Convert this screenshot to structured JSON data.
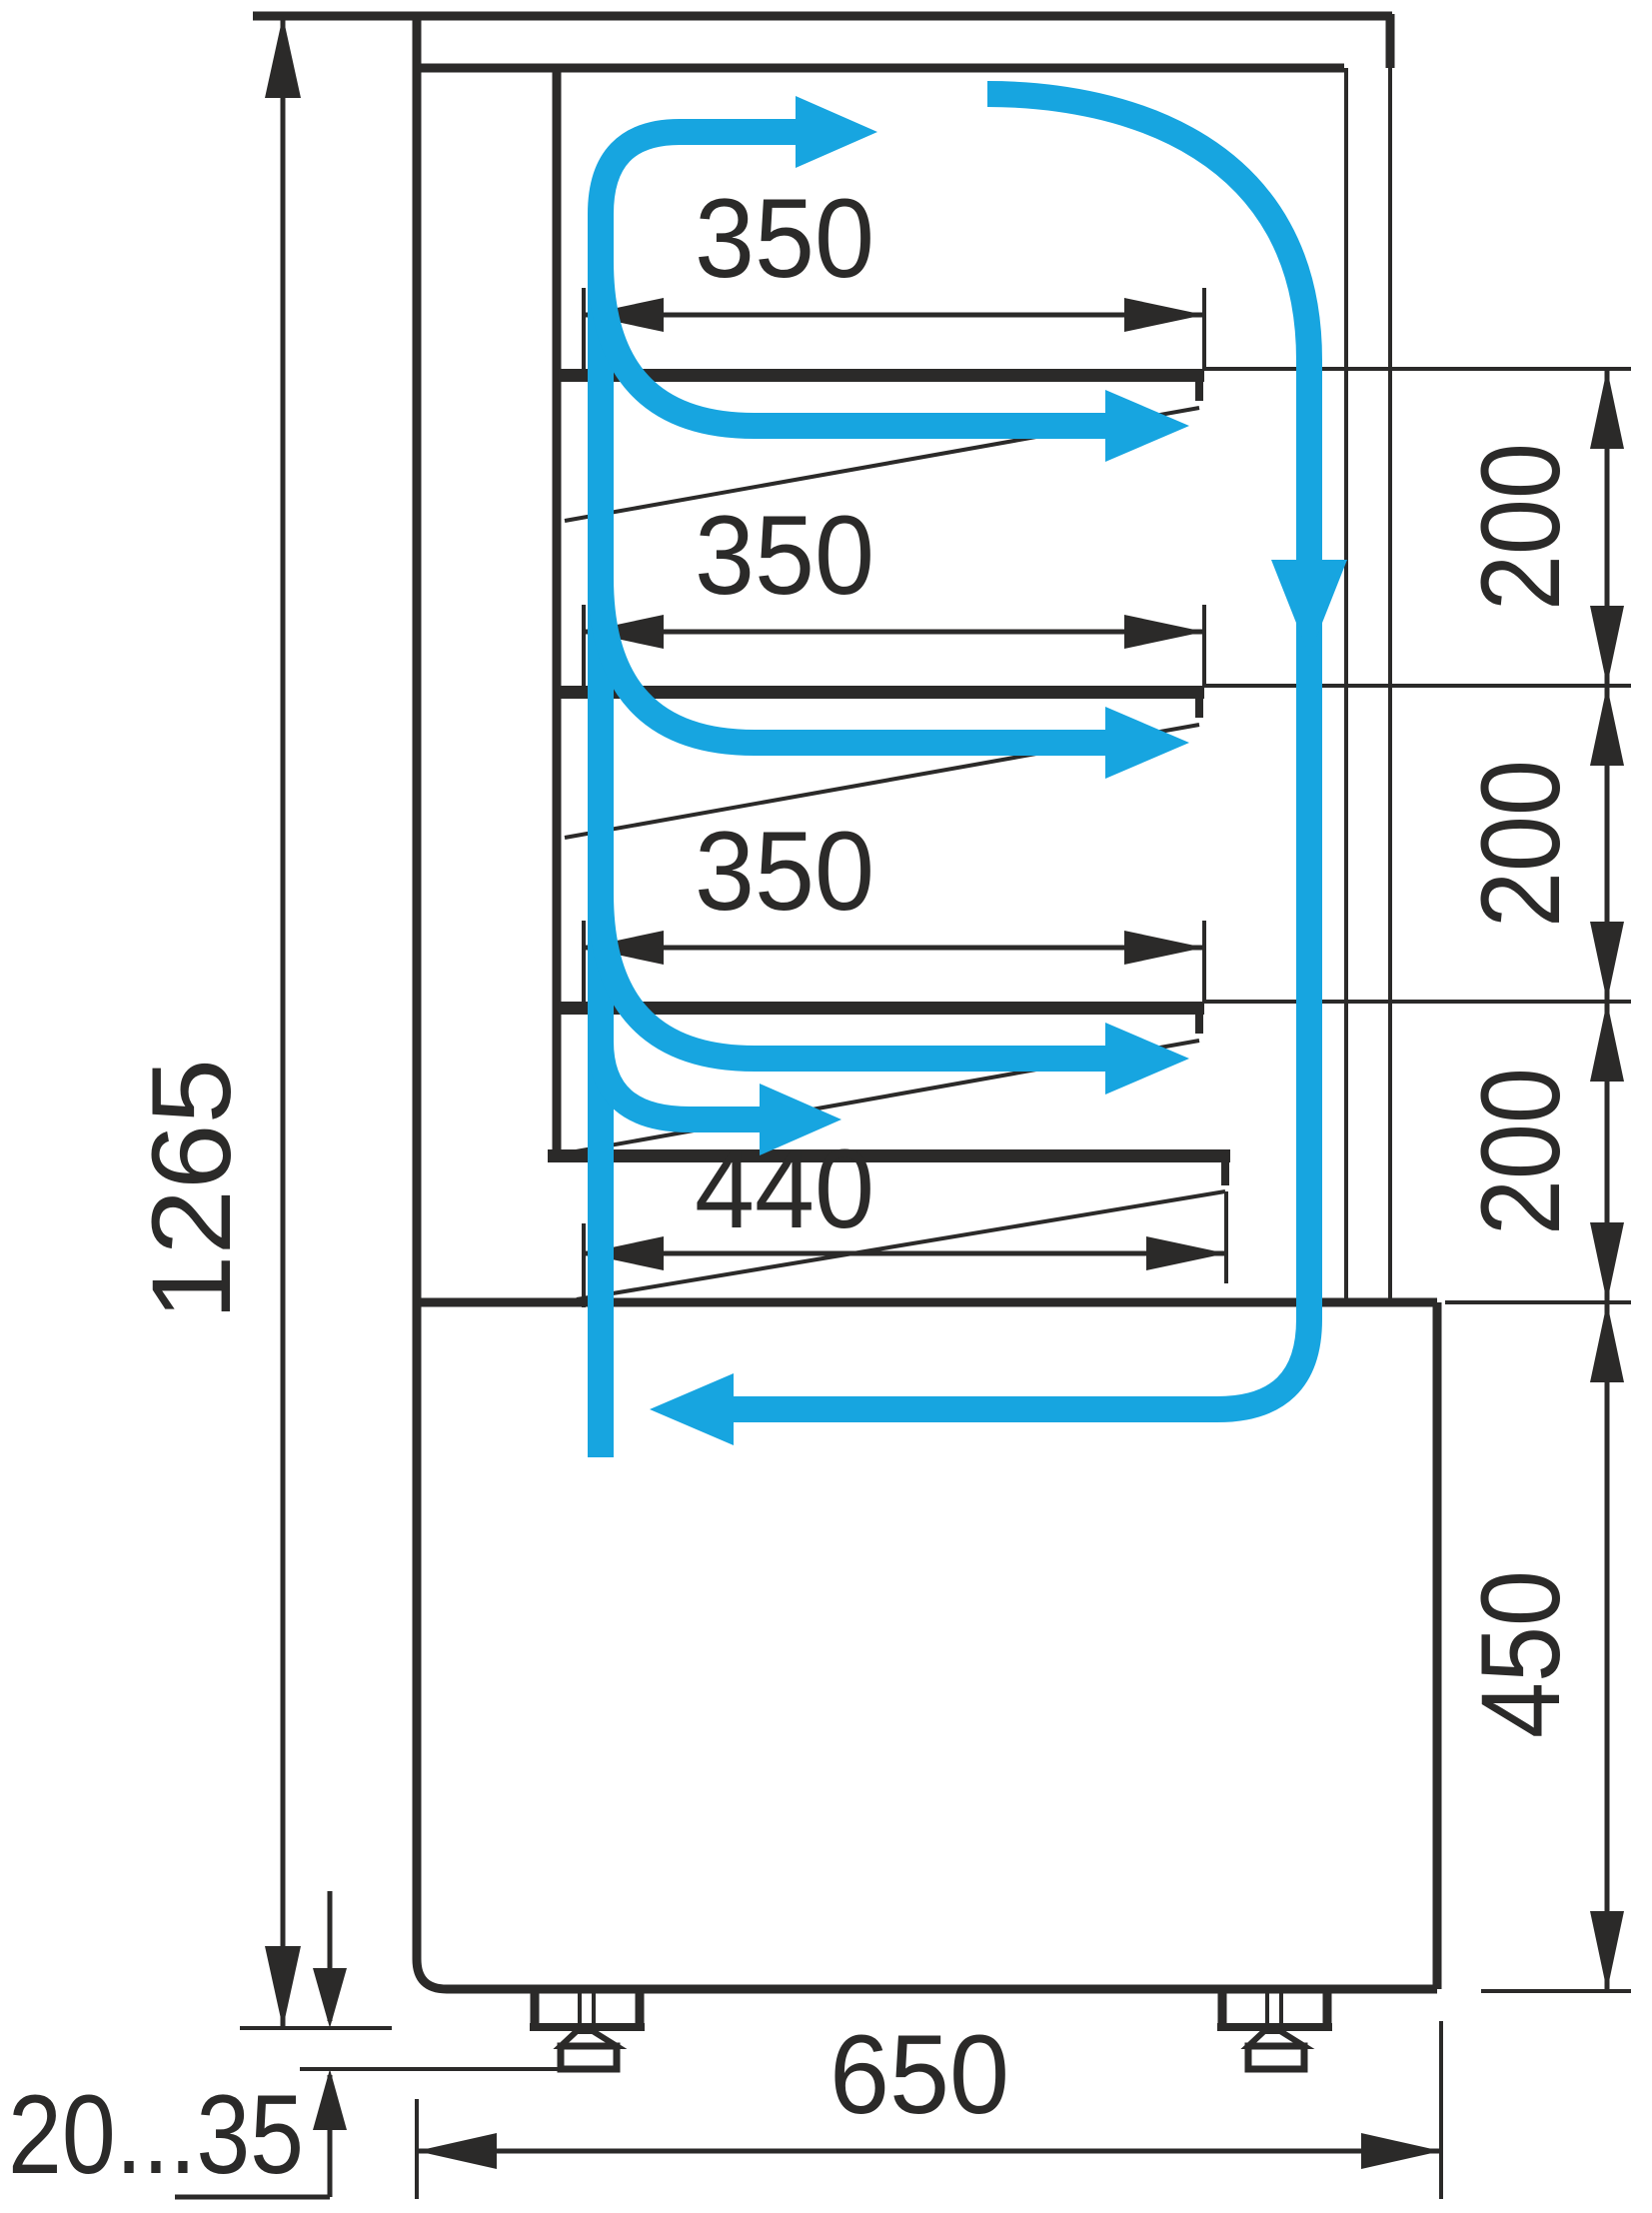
{
  "diagram": {
    "type": "technical-drawing",
    "subject": "Refrigerated patisserie display case — side cross-section with cooling airflow circulation",
    "background_color": "#ffffff",
    "line_color": "#2b2a29",
    "airflow_color": "#17a5e0",
    "dims": {
      "overall_height": "1265",
      "shelf_depth_labels": [
        "350",
        "350",
        "350"
      ],
      "bottom_shelf_depth": "440",
      "shelf_gap_labels": [
        "200",
        "200",
        "200"
      ],
      "base_section_height": "450",
      "overall_depth": "650",
      "leg_height_range": "20...35"
    }
  }
}
